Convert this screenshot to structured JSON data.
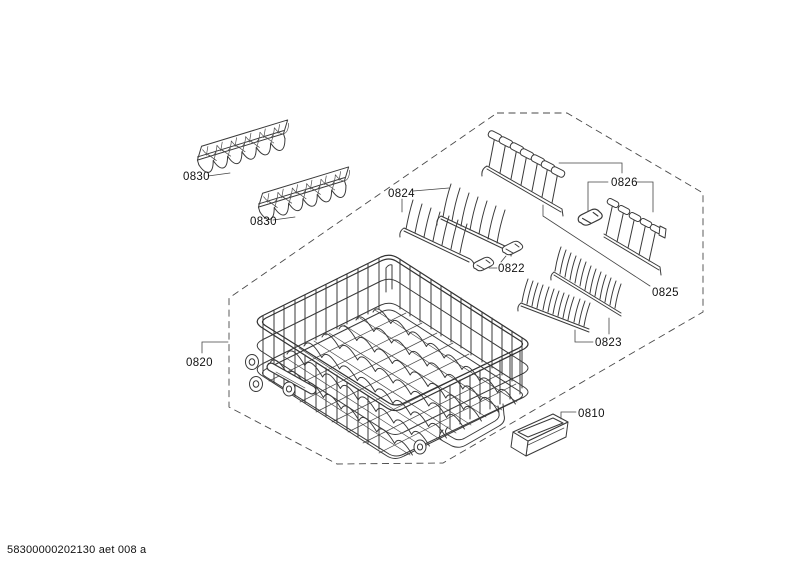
{
  "page": {
    "background": "#ffffff",
    "line_color": "#3a3a3a",
    "label_color": "#111111"
  },
  "footer": {
    "doc_code": "58300000202130 aet 008 a"
  },
  "parts": [
    {
      "label": "0830",
      "name": "cup-rack-insert-upper"
    },
    {
      "label": "0830",
      "name": "cup-rack-insert-lower"
    },
    {
      "label": "0824",
      "name": "folding-tine-row-pair"
    },
    {
      "label": "0822",
      "name": "tine-row-bearing-clips"
    },
    {
      "label": "0826",
      "name": "tine-row-small-with-clip"
    },
    {
      "label": "0825",
      "name": "tine-row-large"
    },
    {
      "label": "0823",
      "name": "plate-rack-combs"
    },
    {
      "label": "0820",
      "name": "lower-basket"
    },
    {
      "label": "0810",
      "name": "storage-tray"
    }
  ]
}
